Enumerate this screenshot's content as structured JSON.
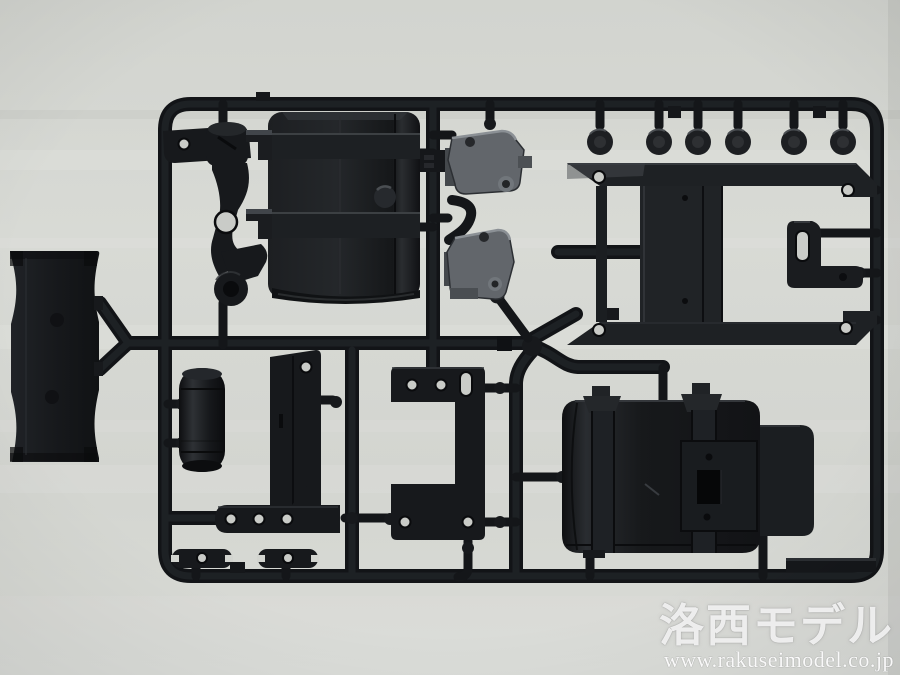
{
  "image": {
    "type": "photograph",
    "subject": "black plastic model-kit sprue (parts tree) photographed on a light gray background"
  },
  "watermark": {
    "logo": "洛西モデル",
    "url": "www.rakuseimodel.co.jp"
  },
  "palette": {
    "background": "#d5d7d2",
    "plastic": "#17191c",
    "plastic_highlight": "#2a2d31",
    "gray_part": "#6a6e72",
    "hole": "#c9cbc7"
  },
  "parts": [
    "steering-bracket",
    "fuel-tank",
    "mounting-bracket-upper",
    "mounting-bracket-lower",
    "tow-eyelets",
    "frame-plate",
    "hook-bracket",
    "axle-mount",
    "air-tank-cylinder",
    "l-bracket",
    "c-bracket-plate",
    "battery-box",
    "back-plate",
    "shackle-plates",
    "part-number-tab"
  ]
}
